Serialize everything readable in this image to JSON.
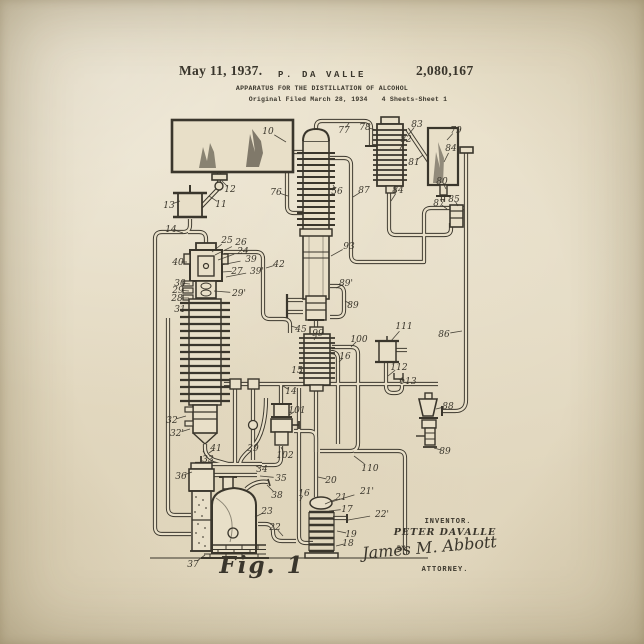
{
  "poster": {
    "header": {
      "date": "May 11, 1937.",
      "inventor_short": "P. DA VALLE",
      "patent_number": "2,080,167",
      "title": "APPARATUS FOR THE DISTILLATION OF ALCOHOL",
      "filed": "Original Filed March 28, 1934",
      "sheet": "4 Sheets-Sheet 1"
    },
    "figure": {
      "label": "Fig. 1"
    },
    "signature": {
      "inventor_caption": "INVENTOR.",
      "inventor_name": "PETER DAVALLE",
      "by": "BY",
      "attorney_signature": "James M. Abbott",
      "attorney_caption": "ATTORNEY."
    },
    "colors": {
      "paper": "#e8dfc8",
      "ink": "#3a362c"
    },
    "diagram": {
      "reference_labels": [
        {
          "t": "10",
          "x": 268,
          "y": 131,
          "tx": 286,
          "ty": 142
        },
        {
          "t": "12",
          "x": 230,
          "y": 189,
          "tx": 222,
          "ty": 181
        },
        {
          "t": "11",
          "x": 221,
          "y": 204,
          "tx": 209,
          "ty": 196
        },
        {
          "t": "13",
          "x": 169,
          "y": 205,
          "tx": 180,
          "ty": 201
        },
        {
          "t": "14",
          "x": 171,
          "y": 229,
          "tx": 183,
          "ty": 233
        },
        {
          "t": "76",
          "x": 276,
          "y": 192,
          "tx": 288,
          "ty": 196
        },
        {
          "t": "77",
          "x": 344,
          "y": 130,
          "tx": 349,
          "ty": 123
        },
        {
          "t": "78",
          "x": 365,
          "y": 127,
          "tx": 376,
          "ty": 130
        },
        {
          "t": "82",
          "x": 406,
          "y": 139,
          "tx": 400,
          "ty": 149
        },
        {
          "t": "83",
          "x": 417,
          "y": 124,
          "tx": 409,
          "ty": 134
        },
        {
          "t": "81",
          "x": 414,
          "y": 162,
          "tx": 423,
          "ty": 155
        },
        {
          "t": "79",
          "x": 456,
          "y": 130,
          "tx": 447,
          "ty": 140
        },
        {
          "t": "84",
          "x": 451,
          "y": 148,
          "tx": 444,
          "ty": 162
        },
        {
          "t": "80",
          "x": 442,
          "y": 181,
          "tx": 446,
          "ty": 189
        },
        {
          "t": "85",
          "x": 454,
          "y": 199,
          "tx": 458,
          "ty": 206
        },
        {
          "t": "87",
          "x": 439,
          "y": 203,
          "tx": 447,
          "ty": 209
        },
        {
          "t": "84",
          "x": 398,
          "y": 190,
          "tx": 391,
          "ty": 201
        },
        {
          "t": "87",
          "x": 364,
          "y": 190,
          "tx": 353,
          "ty": 197
        },
        {
          "t": "86",
          "x": 444,
          "y": 334,
          "tx": 462,
          "ty": 331
        },
        {
          "t": "56",
          "x": 337,
          "y": 191,
          "tx": 333,
          "ty": 185
        },
        {
          "t": "93",
          "x": 349,
          "y": 246,
          "tx": 331,
          "ty": 256
        },
        {
          "t": "89'",
          "x": 346,
          "y": 283,
          "tx": 336,
          "ty": 288
        },
        {
          "t": "89",
          "x": 353,
          "y": 305,
          "tx": 345,
          "ty": 301
        },
        {
          "t": "42",
          "x": 279,
          "y": 264,
          "tx": 266,
          "ty": 268
        },
        {
          "t": "45",
          "x": 301,
          "y": 329,
          "tx": 291,
          "ty": 326
        },
        {
          "t": "99",
          "x": 318,
          "y": 333,
          "tx": 314,
          "ty": 340
        },
        {
          "t": "100",
          "x": 359,
          "y": 339,
          "tx": 351,
          "ty": 347
        },
        {
          "t": "16",
          "x": 345,
          "y": 356,
          "tx": 339,
          "ty": 362
        },
        {
          "t": "15",
          "x": 297,
          "y": 370,
          "tx": 305,
          "ty": 374
        },
        {
          "t": "111",
          "x": 404,
          "y": 326,
          "tx": 391,
          "ty": 341
        },
        {
          "t": "112",
          "x": 399,
          "y": 367,
          "tx": 388,
          "ty": 376
        },
        {
          "t": "113",
          "x": 408,
          "y": 381,
          "tx": 398,
          "ty": 379
        },
        {
          "t": "88",
          "x": 448,
          "y": 406,
          "tx": 436,
          "ty": 409
        },
        {
          "t": "89",
          "x": 445,
          "y": 451,
          "tx": 434,
          "ty": 448
        },
        {
          "t": "101",
          "x": 297,
          "y": 410,
          "tx": 289,
          "ty": 415
        },
        {
          "t": "102",
          "x": 285,
          "y": 455,
          "tx": 281,
          "ty": 447
        },
        {
          "t": "14",
          "x": 291,
          "y": 391,
          "tx": 283,
          "ty": 386
        },
        {
          "t": "25",
          "x": 227,
          "y": 240,
          "tx": 212,
          "ty": 252
        },
        {
          "t": "26",
          "x": 241,
          "y": 242,
          "tx": 215,
          "ty": 255
        },
        {
          "t": "24",
          "x": 243,
          "y": 251,
          "tx": 218,
          "ty": 260
        },
        {
          "t": "39",
          "x": 251,
          "y": 259,
          "tx": 221,
          "ty": 265
        },
        {
          "t": "27",
          "x": 237,
          "y": 271,
          "tx": 222,
          "ty": 272
        },
        {
          "t": "39'",
          "x": 257,
          "y": 271,
          "tx": 226,
          "ty": 277
        },
        {
          "t": "29'",
          "x": 239,
          "y": 293,
          "tx": 214,
          "ty": 291
        },
        {
          "t": "40",
          "x": 178,
          "y": 262,
          "tx": 187,
          "ty": 262
        },
        {
          "t": "30",
          "x": 180,
          "y": 283,
          "tx": 190,
          "ty": 284
        },
        {
          "t": "29",
          "x": 178,
          "y": 290,
          "tx": 189,
          "ty": 291
        },
        {
          "t": "28",
          "x": 177,
          "y": 298,
          "tx": 189,
          "ty": 298
        },
        {
          "t": "31",
          "x": 180,
          "y": 309,
          "tx": 190,
          "ty": 310
        },
        {
          "t": "32",
          "x": 172,
          "y": 420,
          "tx": 186,
          "ty": 416
        },
        {
          "t": "32'",
          "x": 177,
          "y": 433,
          "tx": 190,
          "ty": 429
        },
        {
          "t": "41",
          "x": 216,
          "y": 448,
          "tx": 209,
          "ty": 453
        },
        {
          "t": "33",
          "x": 208,
          "y": 459,
          "tx": 203,
          "ty": 451
        },
        {
          "t": "39",
          "x": 253,
          "y": 448,
          "tx": 258,
          "ty": 442
        },
        {
          "t": "34",
          "x": 262,
          "y": 469,
          "tx": 256,
          "ty": 466
        },
        {
          "t": "35",
          "x": 281,
          "y": 478,
          "tx": 260,
          "ty": 476
        },
        {
          "t": "38",
          "x": 277,
          "y": 495,
          "tx": 267,
          "ty": 485
        },
        {
          "t": "36",
          "x": 181,
          "y": 476,
          "tx": 192,
          "ty": 472
        },
        {
          "t": "37",
          "x": 193,
          "y": 564,
          "tx": 205,
          "ty": 555
        },
        {
          "t": "23",
          "x": 267,
          "y": 511,
          "tx": 255,
          "ty": 517
        },
        {
          "t": "22",
          "x": 275,
          "y": 527,
          "tx": 283,
          "ty": 536
        },
        {
          "t": "20",
          "x": 331,
          "y": 480,
          "tx": 318,
          "ty": 477
        },
        {
          "t": "110",
          "x": 370,
          "y": 468,
          "tx": 354,
          "ty": 456
        },
        {
          "t": "21",
          "x": 341,
          "y": 497,
          "tx": 325,
          "ty": 504
        },
        {
          "t": "21'",
          "x": 367,
          "y": 491,
          "tx": 331,
          "ty": 502
        },
        {
          "t": "17",
          "x": 347,
          "y": 509,
          "tx": 329,
          "ty": 511
        },
        {
          "t": "22'",
          "x": 382,
          "y": 514,
          "tx": 348,
          "ty": 520
        },
        {
          "t": "19",
          "x": 351,
          "y": 534,
          "tx": 337,
          "ty": 531
        },
        {
          "t": "18",
          "x": 348,
          "y": 543,
          "tx": 336,
          "ty": 546
        },
        {
          "t": "16",
          "x": 304,
          "y": 493,
          "tx": 300,
          "ty": 501
        }
      ]
    }
  }
}
